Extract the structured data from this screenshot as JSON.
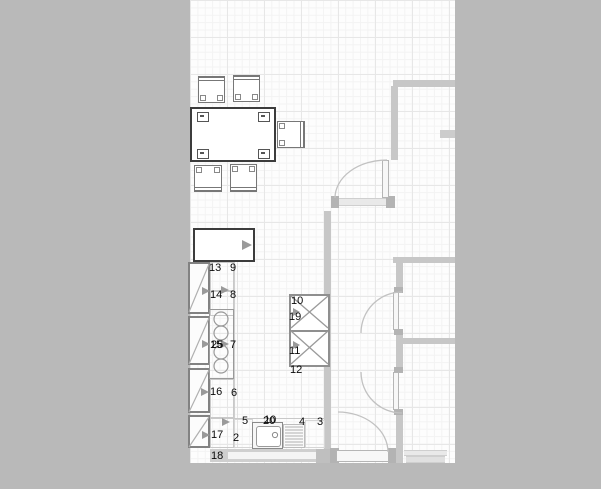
{
  "meta": {
    "app": "kitchen-floor-plan-view",
    "description": "CAD style kitchen floor plan with numbered fixtures, dining set, sink counter, tall cabinet columns, walls and door swings"
  },
  "colors": {
    "pasteboard": "#b9b9b9",
    "floor": "#fdfdfd",
    "grid-major": "#e7e7e7",
    "grid-minor": "#f3f3f3",
    "wall": "#c7c7c7",
    "post": "#b3b3b3",
    "outline-dark": "#3c3c3c",
    "outline-mid": "#8a8a8a",
    "arrow": "#9a9a9a",
    "label": "#0a0a0a"
  },
  "plan": {
    "item_labels": [
      {
        "id": "13",
        "x": 209,
        "y": 262
      },
      {
        "id": "9",
        "x": 230,
        "y": 262
      },
      {
        "id": "14",
        "x": 210,
        "y": 289
      },
      {
        "id": "8",
        "x": 230,
        "y": 289
      },
      {
        "id": "15",
        "x": 210,
        "y": 339
      },
      {
        "id": "25",
        "x": 211,
        "y": 339
      },
      {
        "id": "7",
        "x": 230,
        "y": 339
      },
      {
        "id": "16",
        "x": 210,
        "y": 386
      },
      {
        "id": "6",
        "x": 231,
        "y": 387
      },
      {
        "id": "17",
        "x": 211,
        "y": 429
      },
      {
        "id": "2",
        "x": 233,
        "y": 432
      },
      {
        "id": "18",
        "x": 211,
        "y": 450
      },
      {
        "id": "5",
        "x": 242,
        "y": 415
      },
      {
        "id": "10",
        "x": 264,
        "y": 414
      },
      {
        "id": "20",
        "x": 263,
        "y": 415
      },
      {
        "id": "4",
        "x": 299,
        "y": 416
      },
      {
        "id": "3",
        "x": 317,
        "y": 416
      },
      {
        "id": "10",
        "x": 291,
        "y": 295
      },
      {
        "id": "19",
        "x": 289,
        "y": 311
      },
      {
        "id": "11",
        "x": 289,
        "y": 345
      },
      {
        "id": "12",
        "x": 290,
        "y": 364
      }
    ]
  }
}
